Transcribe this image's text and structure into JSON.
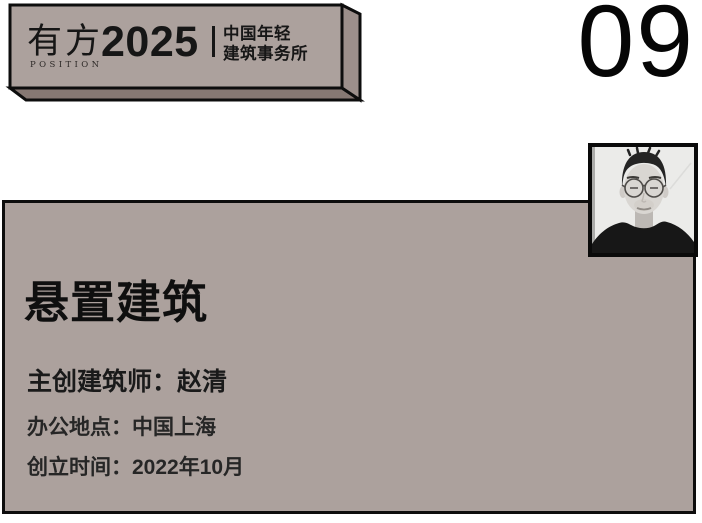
{
  "theme": {
    "surface": "#aca19d",
    "surface_side": "#9c8f8b",
    "surface_bottom": "#867873",
    "outline": "#0d0d0d",
    "text": "#161616",
    "page_bg": "#ffffff"
  },
  "banner": {
    "brand": "有方",
    "brand_sub": "POSITION",
    "year": "2025",
    "tagline_line1": "中国年轻",
    "tagline_line2": "建筑事务所"
  },
  "index_number": "09",
  "card": {
    "studio_name": "悬置建筑",
    "architect": "主创建筑师：赵清",
    "location": "办公地点：中国上海",
    "founded": "创立时间：2022年10月"
  }
}
